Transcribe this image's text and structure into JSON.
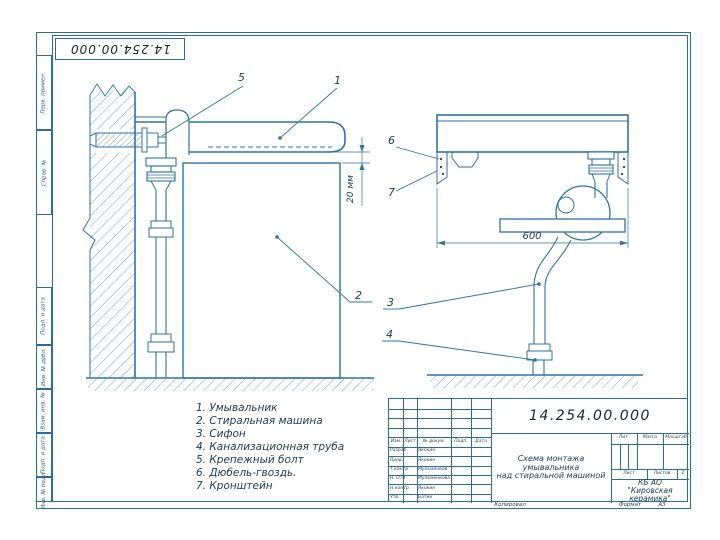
{
  "sheet": {
    "stamp_number": "14.254.00.000",
    "kopiroval": "Копировал",
    "format_label": "Формат",
    "format_value": "А3"
  },
  "frame_fields": [
    "Перв. примен.",
    "Справ. №",
    "Подп. и дата",
    "Инв. № дубл.",
    "Взам. инв. №",
    "Подп. и дата",
    "Инв. № подл."
  ],
  "callouts": {
    "c1": "1",
    "c2": "2",
    "c3": "3",
    "c4": "4",
    "c5": "5",
    "c6": "6",
    "c7": "7"
  },
  "dimensions": {
    "gap": "20 мм",
    "width": "600"
  },
  "parts_list": [
    "1. Умывальник",
    "2. Стиральная машина",
    "3. Сифон",
    "4. Канализационная труба",
    "5. Крепежный болт",
    "6. Дюбель-гвоздь.",
    "7. Кронштейн"
  ],
  "title_block": {
    "doc_number": "14.254.00.000",
    "title_line1": "Схема монтажа",
    "title_line2": "умывальника",
    "title_line3": "над стиральной машиной",
    "col_izm": "Изм.",
    "col_list": "Лист",
    "col_dokum": "№ докум.",
    "col_podp": "Подп.",
    "col_data": "Дата",
    "staff": [
      {
        "role": "Разраб.",
        "name": "Якокин"
      },
      {
        "role": "Пров.",
        "name": "Якокин"
      },
      {
        "role": "Т.контр.",
        "name": "Мульменков"
      },
      {
        "role": "Н. ОТК",
        "name": "Мульменкова"
      },
      {
        "role": "Н.контр.",
        "name": "Якокин"
      },
      {
        "role": "Утв.",
        "name": "Батин"
      }
    ],
    "lit_label": "Лит.",
    "mass_label": "Масса",
    "scale_label": "Масштаб",
    "sheet_label": "Лист",
    "sheets_label": "Листов",
    "sheets_value": "1",
    "company_line1": "КБ АО",
    "company_line2": "\"Кировская керамика\""
  }
}
